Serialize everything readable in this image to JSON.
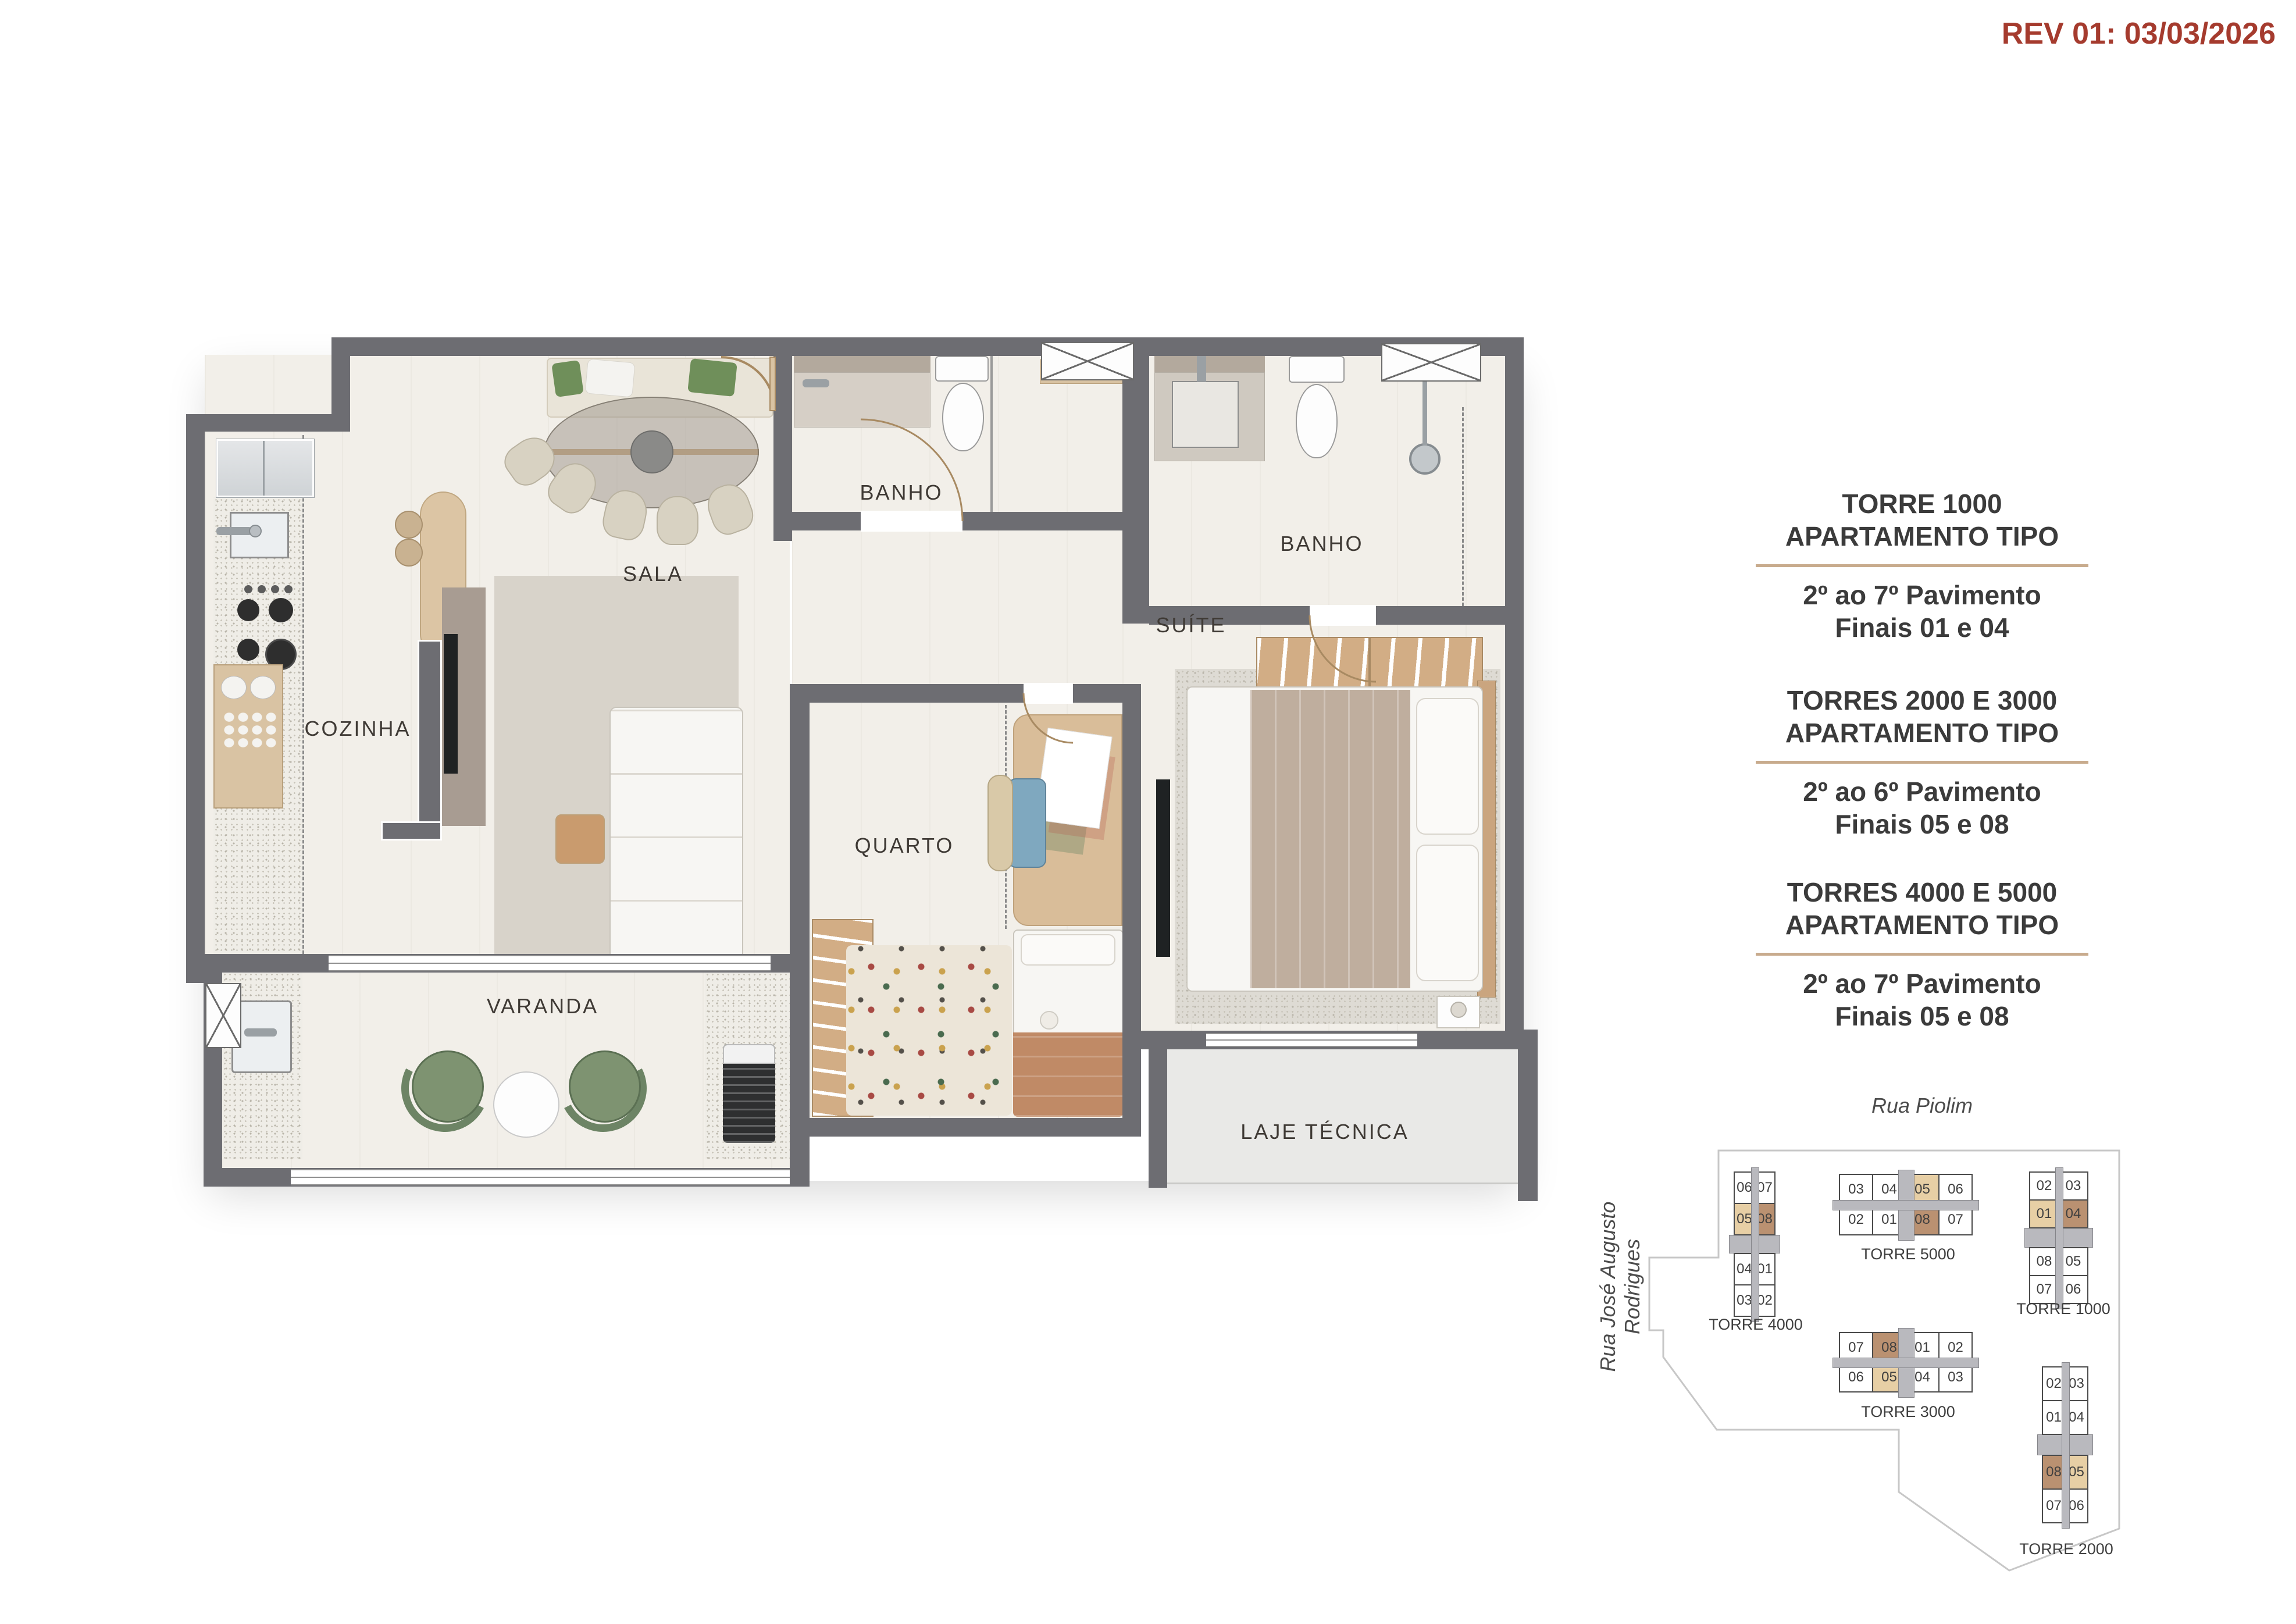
{
  "revision": "REV 01: 03/03/2026",
  "floorplan": {
    "labels": {
      "sala": "SALA",
      "banho1": "BANHO",
      "banho2": "BANHO",
      "cozinha": "COZINHA",
      "quarto": "QUARTO",
      "suite": "SUÍTE",
      "varanda": "VARANDA",
      "laje": "LAJE TÉCNICA"
    }
  },
  "info_blocks": [
    {
      "title": "TORRE 1000",
      "subtitle": "APARTAMENTO TIPO",
      "line1": "2º ao 7º Pavimento",
      "line2": "Finais 01 e 04"
    },
    {
      "title": "TORRES 2000 E 3000",
      "subtitle": "APARTAMENTO TIPO",
      "line1": "2º ao 6º Pavimento",
      "line2": "Finais 05 e 08"
    },
    {
      "title": "TORRES 4000 E 5000",
      "subtitle": "APARTAMENTO TIPO",
      "line1": "2º ao 7º Pavimento",
      "line2": "Finais 05 e 08"
    }
  ],
  "site_plan": {
    "streets": [
      {
        "name": "Rua Piolim"
      },
      {
        "name": "Rua José Augusto Rodrigues"
      }
    ],
    "towers": [
      {
        "name": "TORRE 4000",
        "orientation": "vertical",
        "rows": [
          [
            "06",
            "07"
          ],
          [
            "05",
            "08"
          ],
          [
            "04",
            "01"
          ],
          [
            "03",
            "02"
          ]
        ],
        "highlight_tan": "05",
        "highlight_brown": "08"
      },
      {
        "name": "TORRE 5000",
        "orientation": "horizontal",
        "rows": [
          [
            "03",
            "04",
            "05",
            "06"
          ],
          [
            "02",
            "01",
            "08",
            "07"
          ]
        ],
        "highlight_tan": "05",
        "highlight_brown": "08"
      },
      {
        "name": "TORRE 1000",
        "orientation": "vertical",
        "rows": [
          [
            "02",
            "03"
          ],
          [
            "01",
            "04"
          ],
          [
            "08",
            "05"
          ],
          [
            "07",
            "06"
          ]
        ],
        "highlight_tan": "01",
        "highlight_brown": "04"
      },
      {
        "name": "TORRE 3000",
        "orientation": "horizontal",
        "rows": [
          [
            "07",
            "08",
            "01",
            "02"
          ],
          [
            "06",
            "05",
            "04",
            "03"
          ]
        ],
        "highlight_tan": "05",
        "highlight_brown": "08"
      },
      {
        "name": "TORRE 2000",
        "orientation": "vertical",
        "rows": [
          [
            "02",
            "03"
          ],
          [
            "01",
            "04"
          ],
          [
            "08",
            "05"
          ],
          [
            "07",
            "06"
          ]
        ],
        "highlight_tan": "05",
        "highlight_brown": "08"
      }
    ]
  },
  "colors": {
    "accent_red": "#a53b2e",
    "divider_tan": "#c8ab8d",
    "wall_gray": "#6d6d72",
    "highlight_tan": "#e7cfa5",
    "highlight_brown": "#ba9171",
    "core_gray": "#b9b9be"
  }
}
